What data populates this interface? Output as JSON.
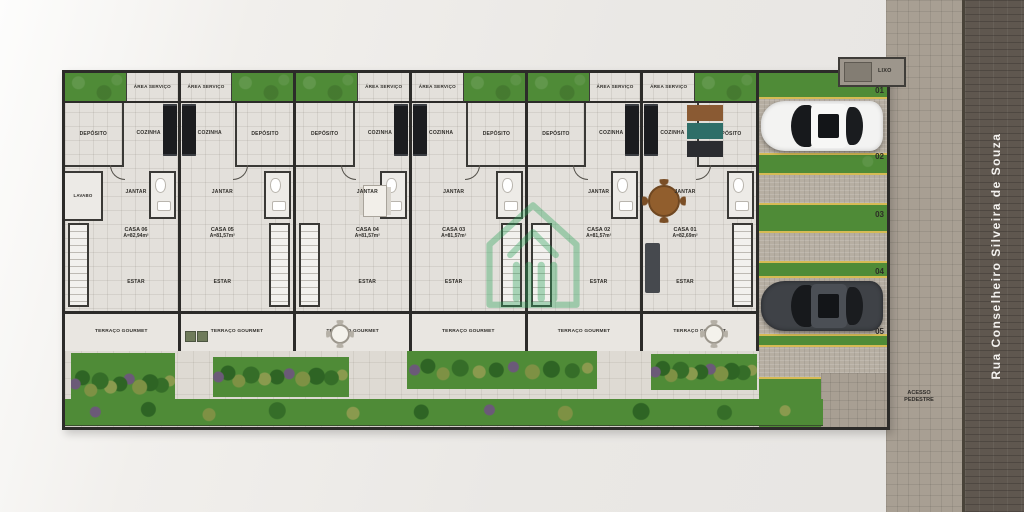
{
  "meta": {
    "type": "residential-site-floor-plan",
    "units_count": 6
  },
  "street": {
    "name": "Rua Conselheiro Silveira de Souza"
  },
  "access": {
    "line1": "ACESSO",
    "line2": "PEDESTRE"
  },
  "site": {
    "trash_label": "LIXO"
  },
  "parking": {
    "spaces": [
      "01",
      "02",
      "03",
      "04",
      "05"
    ]
  },
  "houses": [
    {
      "name": "CASA 06",
      "area": "A=82,94m²",
      "rooms": {
        "area_servico": "ÁREA SERVIÇO",
        "cozinha": "COZINHA",
        "deposito": "DEPÓSITO",
        "lavabo": "LAVABO",
        "jantar": "JANTAR",
        "estar": "ESTAR",
        "terraco": "TERRAÇO GOURMET"
      }
    },
    {
      "name": "CASA 05",
      "area": "A=81,57m²",
      "rooms": {
        "area_servico": "ÁREA SERVIÇO",
        "cozinha": "COZINHA",
        "deposito": "DEPÓSITO",
        "jantar": "JANTAR",
        "estar": "ESTAR",
        "terraco": "TERRAÇO GOURMET"
      }
    },
    {
      "name": "CASA 04",
      "area": "A=81,57m²",
      "rooms": {
        "area_servico": "ÁREA SERVIÇO",
        "cozinha": "COZINHA",
        "deposito": "DEPÓSITO",
        "jantar": "JANTAR",
        "estar": "ESTAR",
        "terraco": "TERRAÇO GOURMET"
      }
    },
    {
      "name": "CASA 03",
      "area": "A=81,57m²",
      "rooms": {
        "area_servico": "ÁREA SERVIÇO",
        "cozinha": "COZINHA",
        "deposito": "DEPÓSITO",
        "jantar": "JANTAR",
        "estar": "ESTAR",
        "terraco": "TERRAÇO GOURMET"
      }
    },
    {
      "name": "CASA 02",
      "area": "A=81,57m²",
      "rooms": {
        "area_servico": "ÁREA SERVIÇO",
        "cozinha": "COZINHA",
        "deposito": "DEPÓSITO",
        "jantar": "JANTAR",
        "estar": "ESTAR",
        "terraco": "TERRAÇO GOURMET"
      }
    },
    {
      "name": "CASA 01",
      "area": "A=82,69m²",
      "rooms": {
        "area_servico": "ÁREA SERVIÇO",
        "cozinha": "COZINHA",
        "deposito": "DEPÓSITO",
        "jantar": "JANTAR",
        "estar": "ESTAR",
        "terraco": "TERRAÇO GOURMET"
      }
    }
  ],
  "colors": {
    "grass": "#4f8b37",
    "street": "#5f574f",
    "sidewalk": "#a89f93",
    "walls": "#2c2b29",
    "floor": "#e3e0db",
    "paver_strip": "#b6aea2",
    "yellow_line": "#d6bb55",
    "logo_green": "#2fa45c"
  }
}
